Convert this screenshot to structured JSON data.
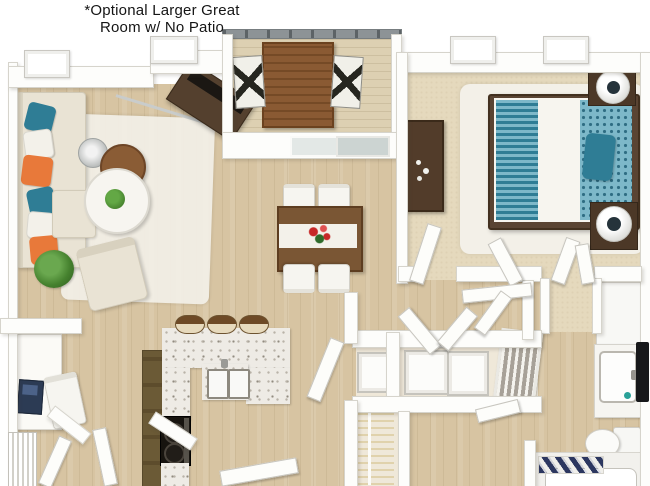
{
  "title": {
    "line1": "*Optional Larger Great",
    "line2": "Room w/ No Patio"
  },
  "palette": {
    "text": "#151515",
    "wall": "#fdfdfb",
    "wall_edge": "#d6d4cc",
    "wood": "#d7c4a2",
    "carpet": "#e5d9bd",
    "deck": "#ddd0b2",
    "counter": "#eeebe5",
    "laundry_floor": "#efe8d9",
    "dark_wood": "#523c2a",
    "mid_wood": "#7a5634",
    "stool_brown": "#6e4a26",
    "teal": "#2f7d95",
    "teal_light": "#7db8c9",
    "orange": "#e8793a",
    "cream": "#e9e3d4",
    "white_rug": "#f3f0e8",
    "green": "#45812e",
    "navy": "#2c3760",
    "appliance": "#fcfcfa",
    "railing": "#8d9396",
    "stove": "#17140f",
    "wire_tan": "#e0d2ac",
    "red": "#c62828",
    "glass_light": "#e3e8e6",
    "glass_dark": "#ccd4d2",
    "chrome": "#c9cccb"
  }
}
